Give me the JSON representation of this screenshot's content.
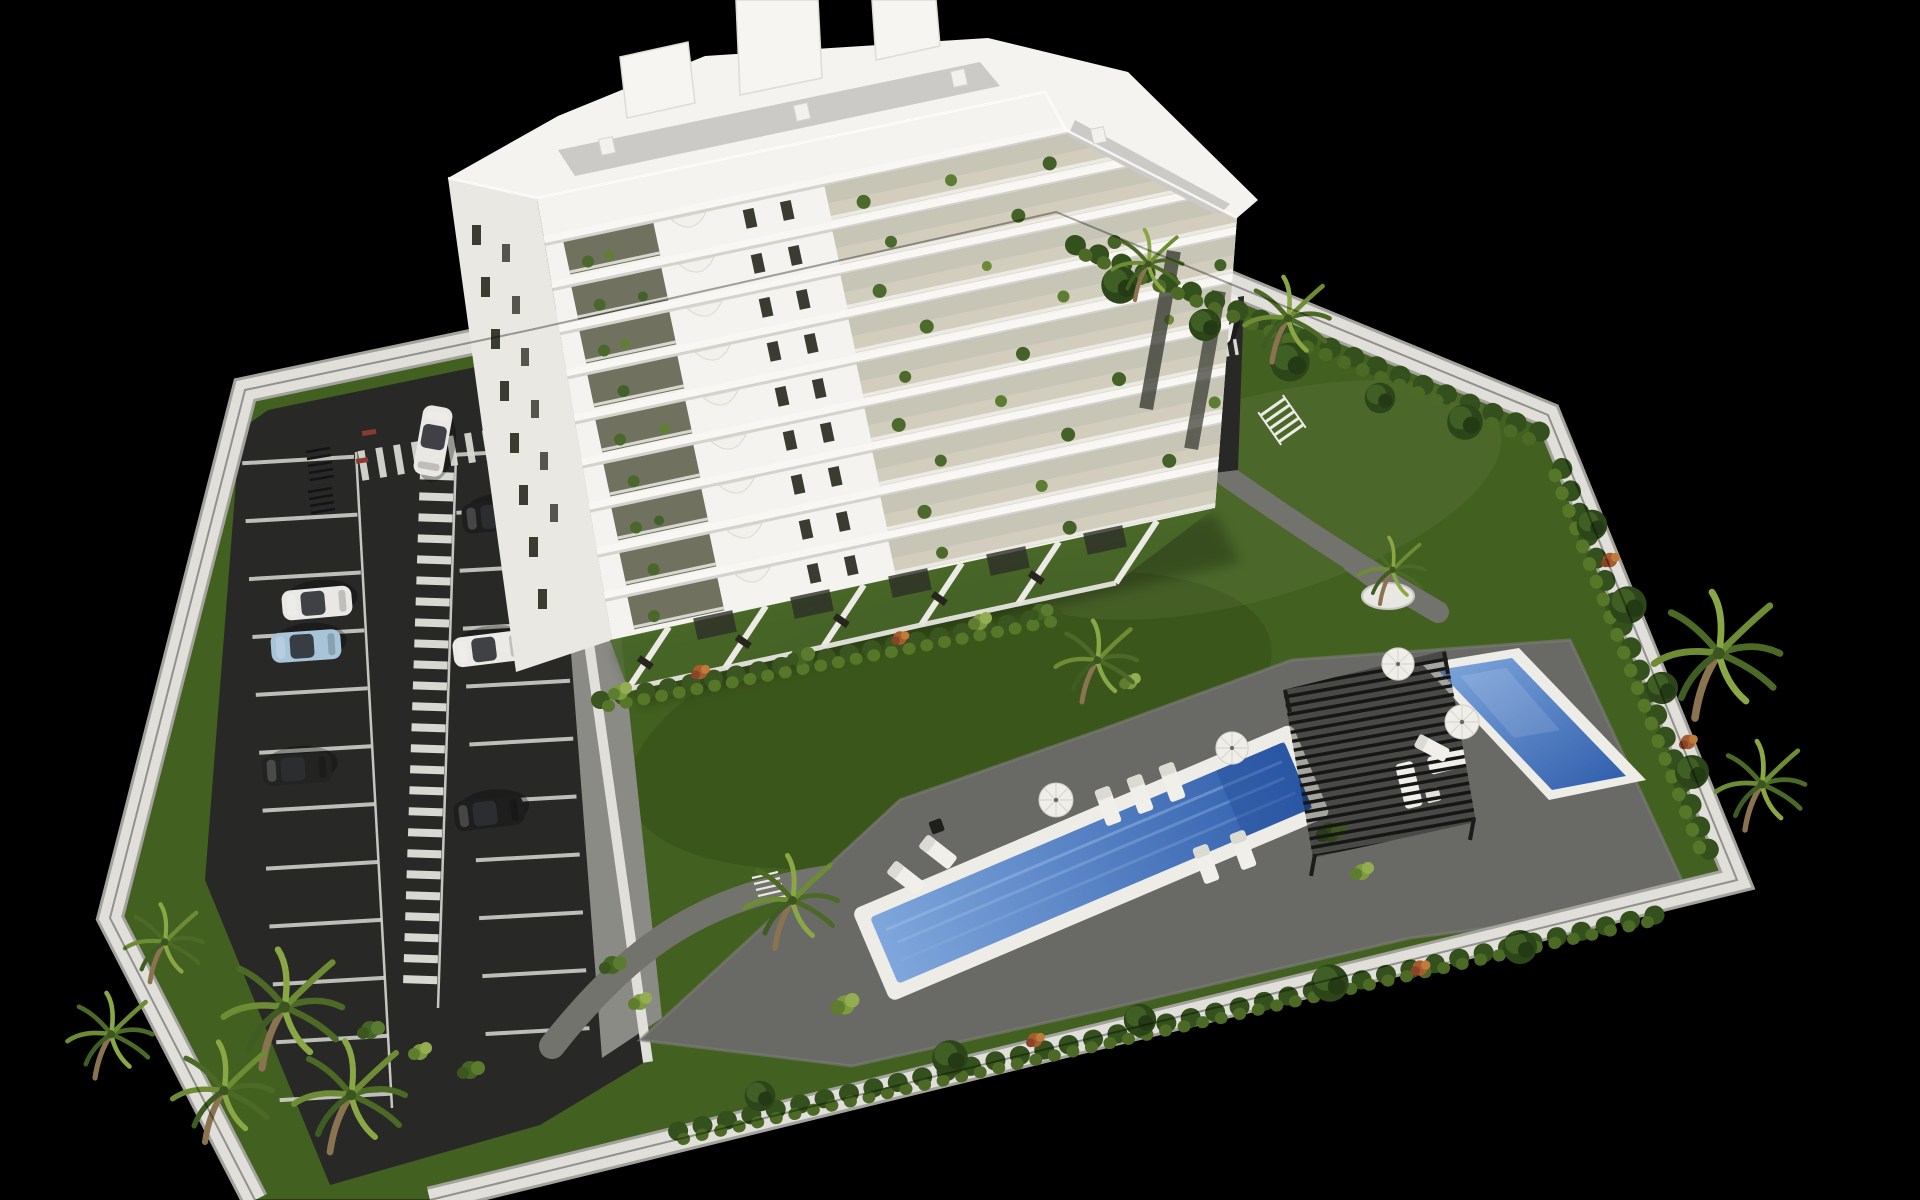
{
  "meta": {
    "kind": "3d-architectural-render",
    "description": "Aerial 3D rendering of a white nine-storey apartment building with glass balconies and plants, a landscaped communal garden with two blue swimming pools, a black slatted pergola with white outdoor furniture, palm trees, and a striped asphalt parking lot, all enclosed by a white perimeter wall on a solid black background."
  },
  "palette": {
    "background": "#000000",
    "perimeter_wall": "#e0dfda",
    "perimeter_wall_edge": "#a3a29c",
    "lawn": "#42601f",
    "lawn_shade": "#334d18",
    "asphalt": "#282827",
    "road_marking": "#d8d8d2",
    "concrete_apron": "#8b8b86",
    "path": "#73736e",
    "pool_deck": "#696966",
    "pool_coping": "#edece6",
    "pool_water_deep": "#2e5cab",
    "pool_water_light": "#7fa7dc",
    "building_white": "#f4f3ef",
    "building_side": "#e9e8e3",
    "building_shade": "#dedcd6",
    "roof_gravel": "#cbcac6",
    "glass_dark": "#3a3c32",
    "terrace_floor": "#cfc9b8",
    "terrace_rail": "#edeee8",
    "pergola": "#161615",
    "foliage_dark": "#2c461a",
    "foliage_mid": "#4c6a26",
    "foliage_light": "#79953c",
    "foliage_accent": "#b06434",
    "trunk": "#8a7350",
    "furniture_white": "#efeee8"
  },
  "building": {
    "name": "white-apartment-block",
    "floors_visible": 9,
    "rooftop_towers": 3,
    "balconies_with_plants": true,
    "ground_floor_private_gardens": 6
  },
  "amenities": {
    "swimming_pools": 2,
    "pergola": 1,
    "parasols": 4,
    "sun_loungers": 8,
    "round_planter": 1,
    "outdoor_gym": 1
  },
  "parking": {
    "stall_columns": 2,
    "pedestrian_walkway": true,
    "bike_racks": 2,
    "cars": [
      {
        "color": "white",
        "hex": "#e9e8e5"
      },
      {
        "color": "black",
        "hex": "#1e1e1e"
      },
      {
        "color": "white",
        "hex": "#e9e8e5"
      },
      {
        "color": "light-blue",
        "hex": "#a7c4d8"
      },
      {
        "color": "white",
        "hex": "#eceae6"
      },
      {
        "color": "black",
        "hex": "#232322"
      },
      {
        "color": "black",
        "hex": "#1e1e1e"
      },
      {
        "color": "white",
        "hex": "#eceae6"
      }
    ]
  },
  "landscape": {
    "palm_trees": 11,
    "hedge_rows": true,
    "lawn": true
  }
}
